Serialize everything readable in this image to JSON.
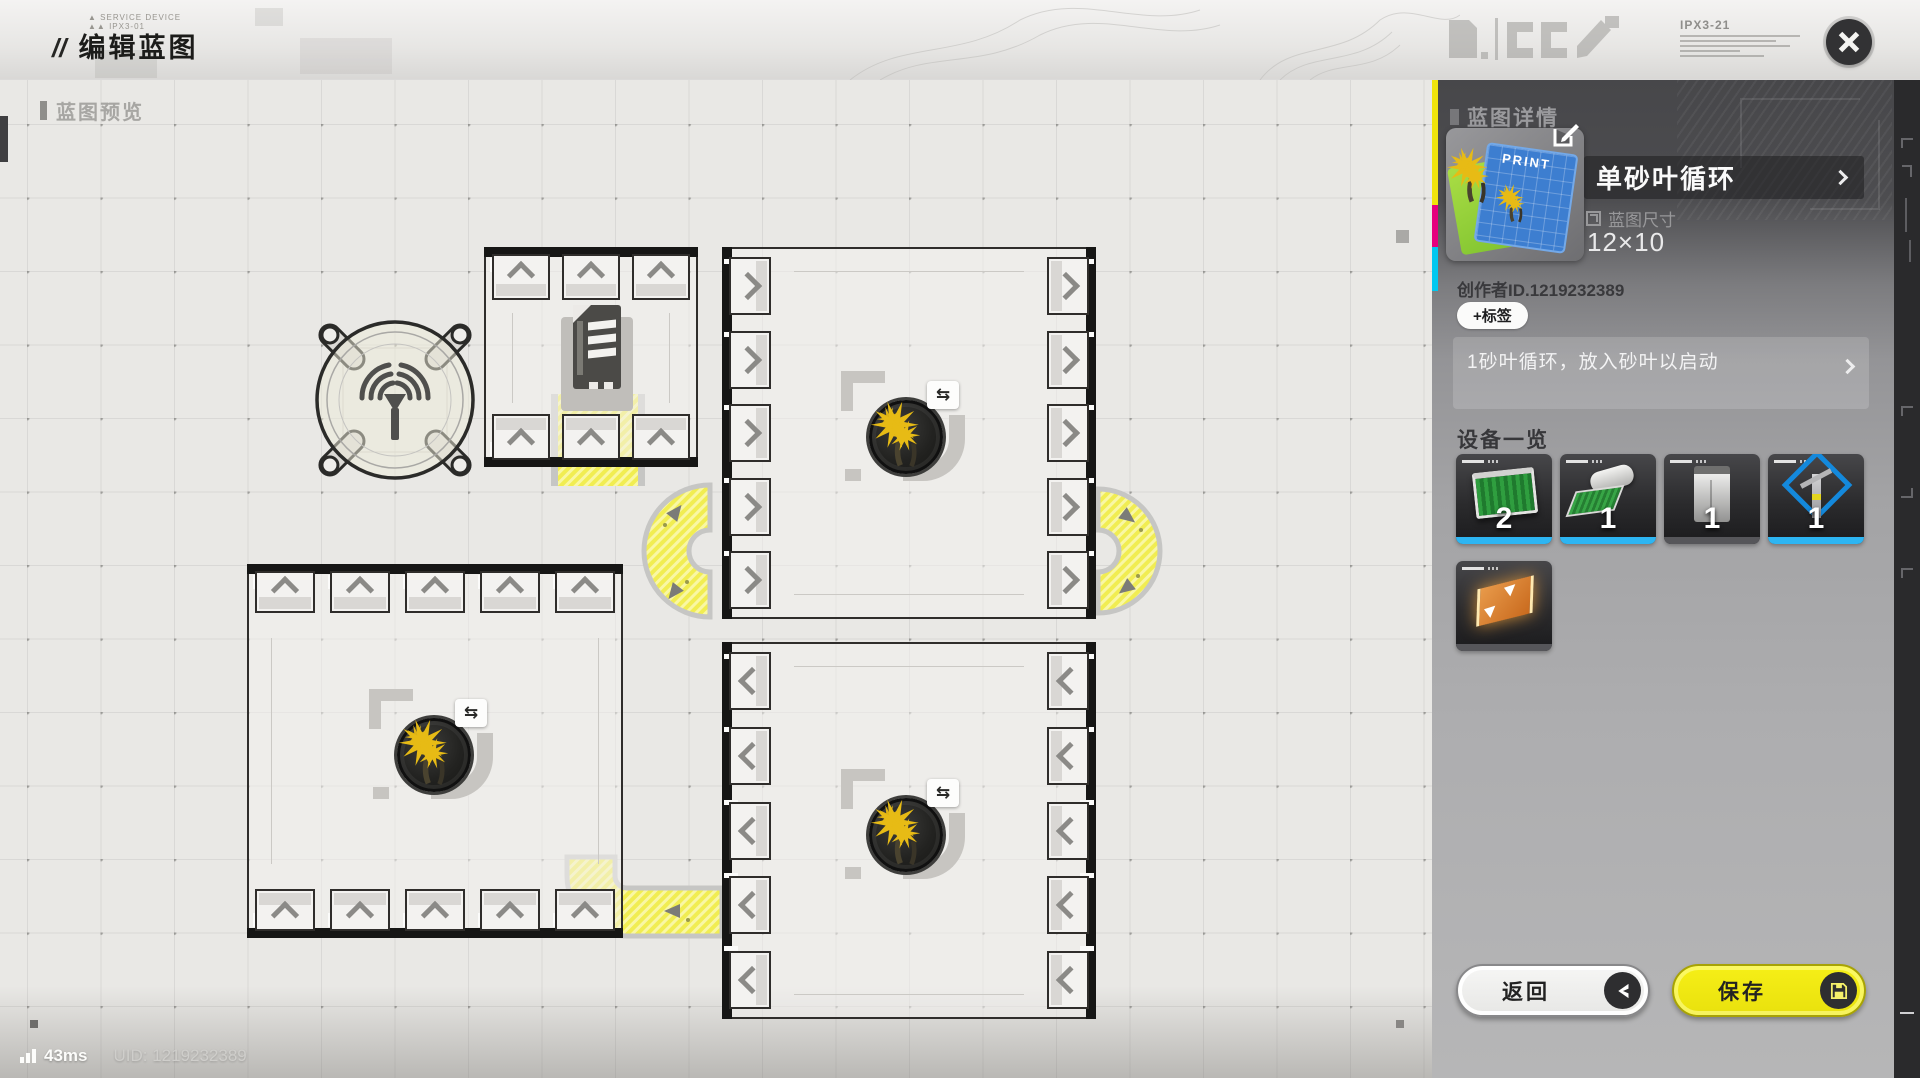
{
  "topbar": {
    "prefix": "//",
    "title": "编辑蓝图",
    "meta_line1": "SERVICE DEVICE",
    "meta_line2": "IPX3-01",
    "device_code": "IPX3-21"
  },
  "canvas": {
    "preview_label": "蓝图预览"
  },
  "statusbar": {
    "ping": "43ms",
    "uid": "UID: 1219232389"
  },
  "panel": {
    "header": "蓝图详情",
    "thumbnail_text": "PRINT",
    "name": "单砂叶循环",
    "size_label": "蓝图尺寸",
    "size_value": "12×10",
    "creator": "创作者ID.1219232389",
    "add_tag": "+标签",
    "description": "1砂叶循环，放入砂叶以启动",
    "equipment_label": "设备一览",
    "equipment": [
      {
        "icon": "planter-unit",
        "count": "2",
        "accent": "#2db5f2"
      },
      {
        "icon": "seed-collector",
        "count": "1",
        "accent": "#2db5f2"
      },
      {
        "icon": "storage-cabinet",
        "count": "1",
        "accent": "#56565a"
      },
      {
        "icon": "power-node",
        "count": "1",
        "accent": "#2db5f2"
      },
      {
        "icon": "conveyor-belt",
        "count": "",
        "accent": "#56565a"
      }
    ],
    "back_label": "返回",
    "save_label": "保存"
  },
  "machines": {
    "swap_badge": "⇆"
  },
  "colors": {
    "conveyor_yellow": "#f1ed52",
    "save_yellow": "#f3eb15",
    "equip_accent_blue": "#2db5f2",
    "strip_yellow": "#f0e40c",
    "strip_magenta": "#e6007e",
    "strip_cyan": "#00c8f0"
  }
}
